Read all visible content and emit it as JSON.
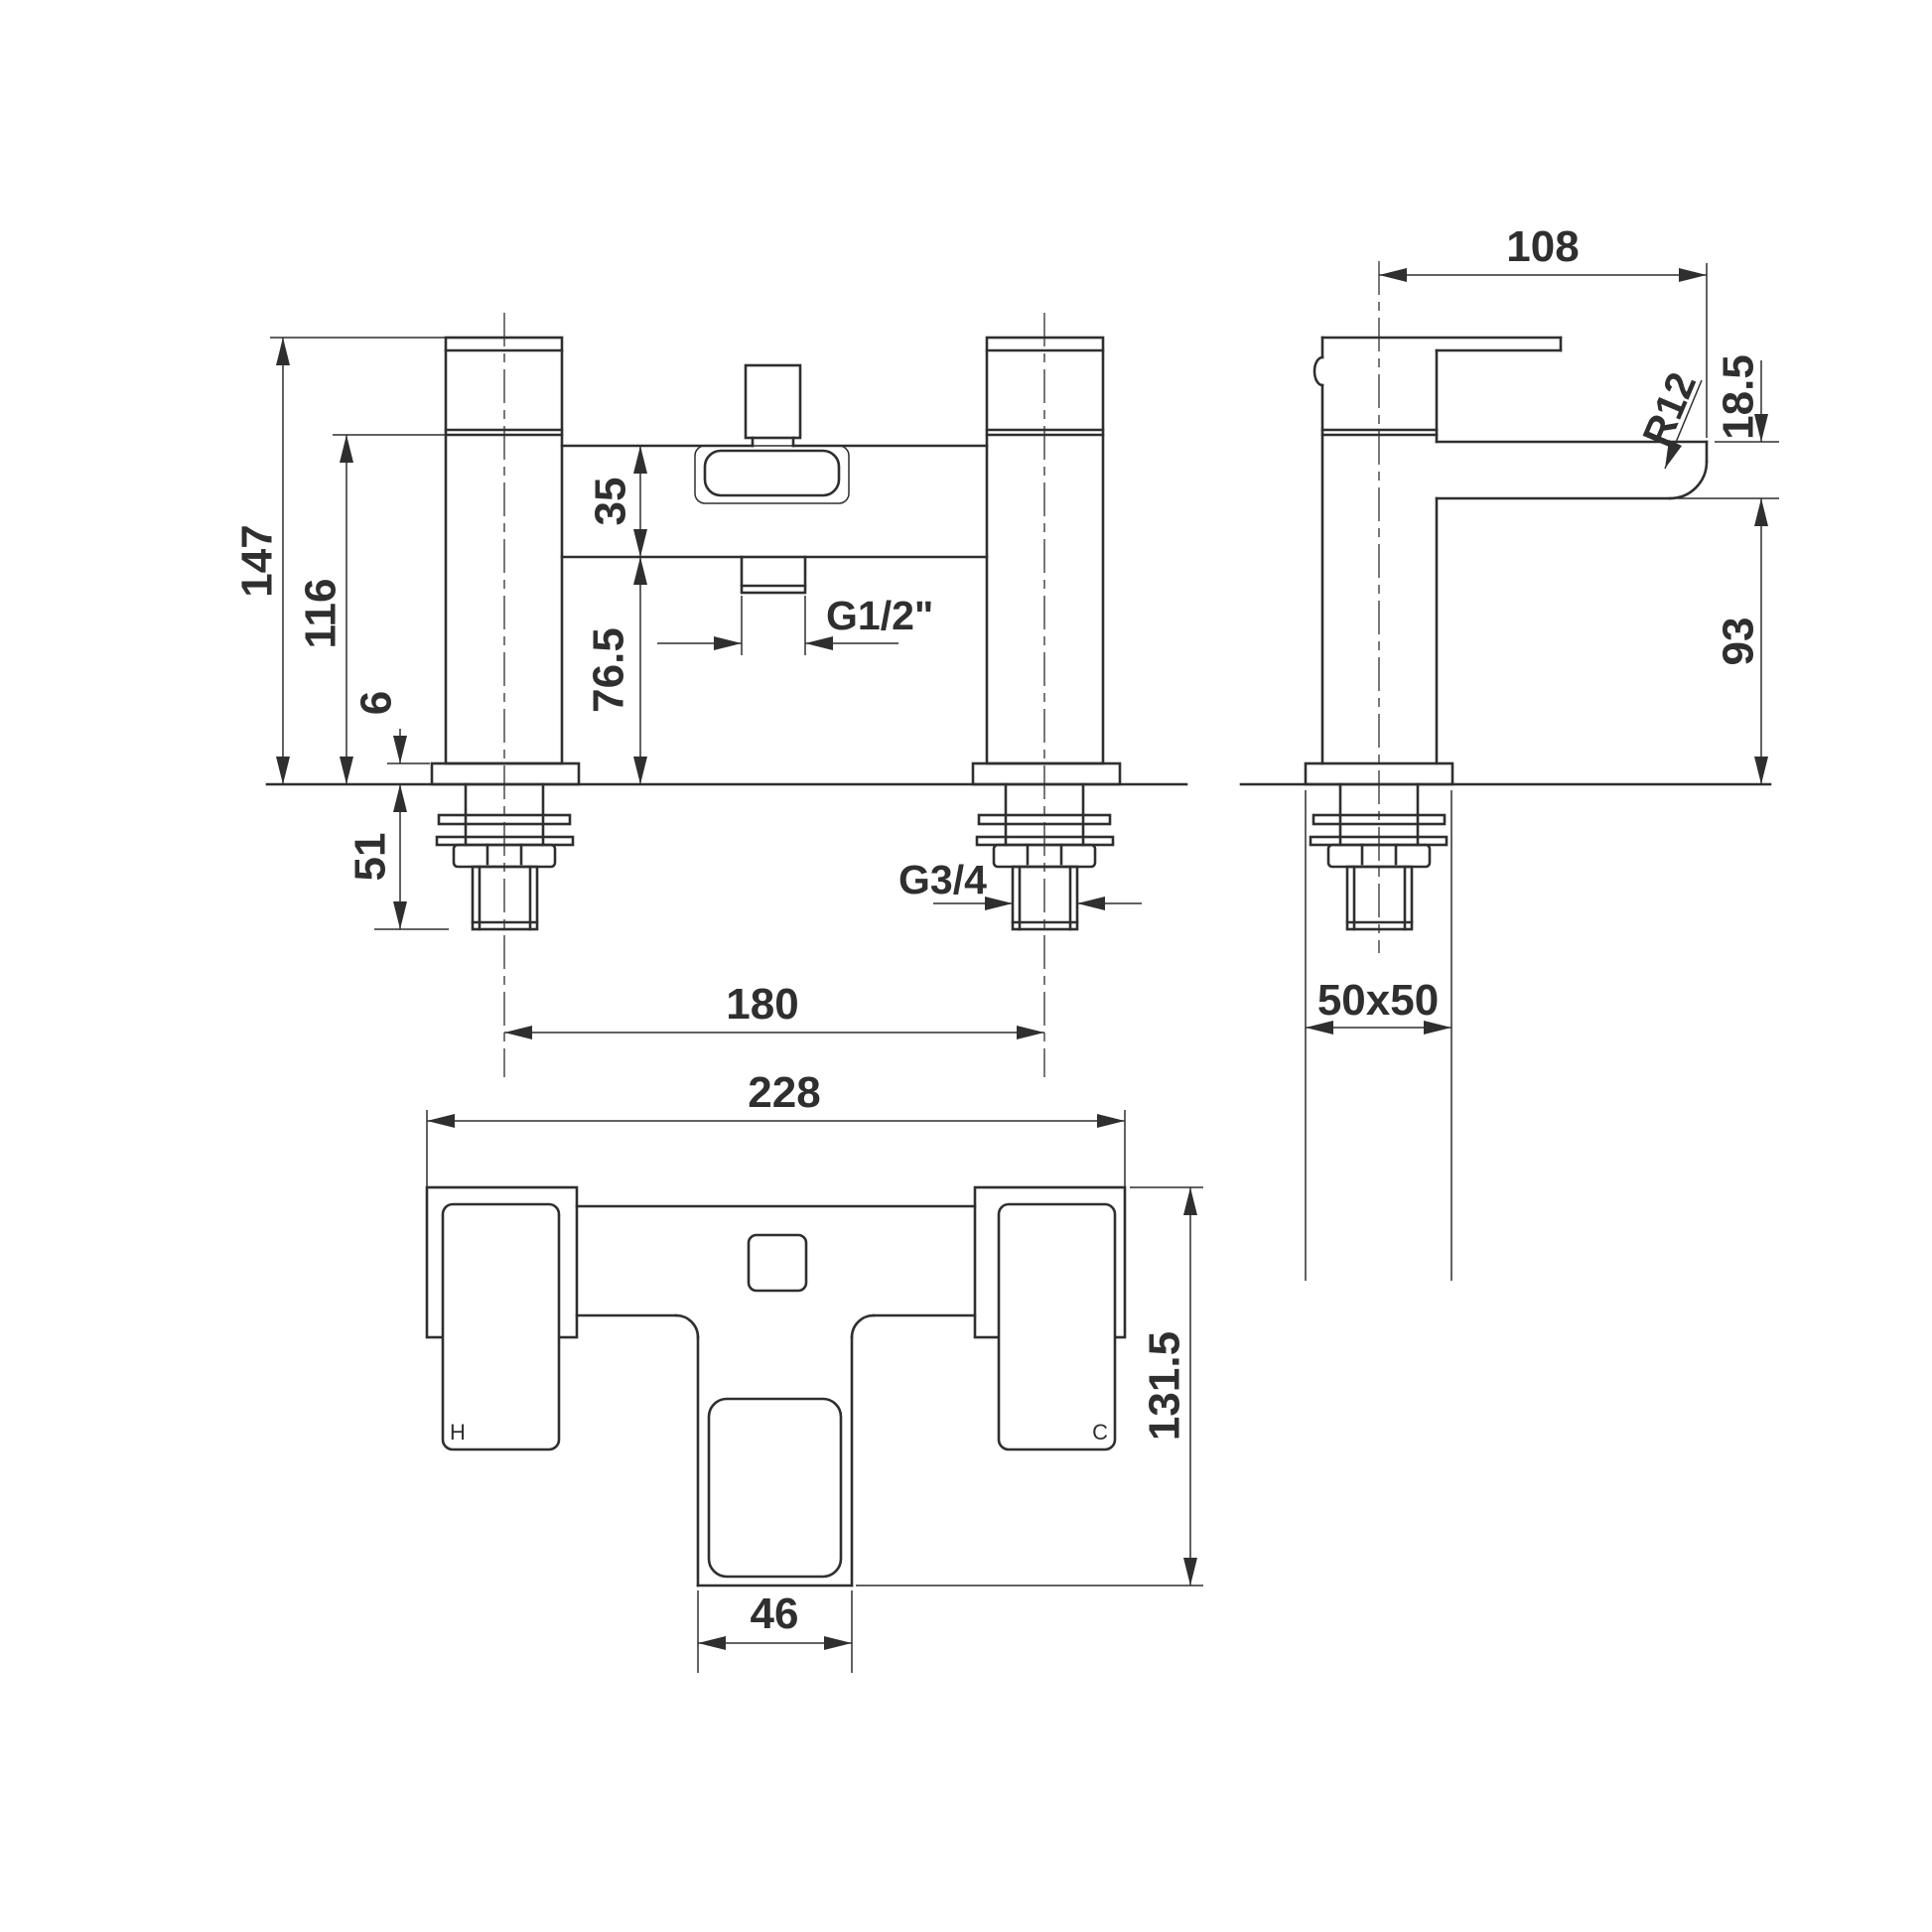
{
  "front_view": {
    "overall_height": "147",
    "body_top_height": "116",
    "body_depth": "35",
    "deck_to_body": "76.5",
    "base_plate_thickness": "6",
    "below_deck_length": "51",
    "tap_centres": "180",
    "shower_hose_thread": "G1/2\"",
    "inlet_thread": "G3/4"
  },
  "side_view": {
    "spout_reach": "108",
    "spout_lip_height": "18.5",
    "spout_radius": "R12",
    "deck_to_spout_underside": "93",
    "base_footprint": "50x50"
  },
  "plan_view": {
    "overall_width": "228",
    "spout_width": "46",
    "overall_depth": "131.5",
    "hot_indicator": "H",
    "cold_indicator": "C"
  },
  "colors": {
    "line": "#2f2f2f",
    "background": "#ffffff"
  }
}
